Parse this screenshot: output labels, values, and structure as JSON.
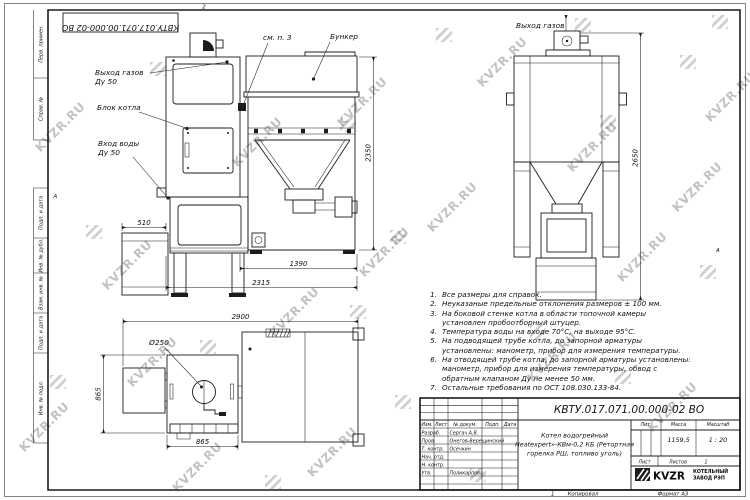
{
  "watermark": {
    "text": "KVZR.RU"
  },
  "colors": {
    "line": "#1c1c1c",
    "watermark": "#8a8a8a",
    "paper": "#ffffff"
  },
  "frame": {
    "stamp_top": "КВТУ.017.071.00.000-02 ВО",
    "zone_top": "2",
    "zone_left": "А",
    "zone_right": "А",
    "margin_labels": [
      "Перв. примен.",
      "Справ. №",
      "Подп. и дата",
      "Инв. № дубл.",
      "Взам. инв. №",
      "Подп. и дата",
      "Инв. № подл."
    ],
    "footer": {
      "num": "1",
      "copied": "Копировал",
      "format": "Формат А3"
    }
  },
  "callouts": {
    "gas_out_left_1": "Выход газов",
    "gas_out_left_2": "Ду 50",
    "boiler_block": "Блок котла",
    "water_in_1": "Вход воды",
    "water_in_2": "Ду 50",
    "see_note": "см. п. 3",
    "bunker": "Бункер",
    "gas_out_right": "Выход газов",
    "diameter": "Ø250"
  },
  "dims": {
    "d510": "510",
    "d1390": "1390",
    "d2315": "2315",
    "d2350": "2350",
    "d2650": "2650",
    "d2900": "2900",
    "d865v": "865",
    "d865h": "865"
  },
  "notes": [
    {
      "num": "1.",
      "text": "Все размеры для справок."
    },
    {
      "num": "2.",
      "text": "Неуказаные предельные отклонения размеров ± 100 мм."
    },
    {
      "num": "3.",
      "text": "На боковой стенке котла в области топочной камеры установлен пробоотборный штуцер."
    },
    {
      "num": "4.",
      "text": "Температура воды на входе 70°С, на выходе 95°С."
    },
    {
      "num": "5.",
      "text": "На подводящей трубе котла, до запорной арматуры установлены: манометр, прибор для измерения температуры."
    },
    {
      "num": "6.",
      "text": "На отводящей трубе котла, до запорной арматуры установлены: манометр, прибор для измерения температуры, обвод с обратным клапаном Ду не менее 50 мм."
    },
    {
      "num": "7.",
      "text": "Остальные требования по ОСТ 108.030.133-84."
    }
  ],
  "title_block": {
    "doc_number": "КВТУ.017.071.00.000-02 ВО",
    "headers": {
      "izm": "Изм.",
      "list": "Лист",
      "doc": "№ докум.",
      "podp": "Подп.",
      "data": "Дата"
    },
    "rows": [
      {
        "role": "Разраб.",
        "name": "Сергач А.В."
      },
      {
        "role": "Пров.",
        "name": "Онегов-Верещинский"
      },
      {
        "role": "Т. контр.",
        "name": "Осечкин"
      },
      {
        "role": "Нач. отд.",
        "name": ""
      },
      {
        "role": "Н. контр.",
        "name": ""
      },
      {
        "role": "Утв.",
        "name": "Поликарпова"
      }
    ],
    "title_l1": "Котел водогрейный",
    "title_l2": "Heatexpert»-КВм-0,2 КБ (Ретортная",
    "title_l3": "горелка РШ, топливо уголь)",
    "lit_label": "Лит.",
    "mass_label": "Масса",
    "scale_label": "Масштаб",
    "mass": "1159,5",
    "scale": "1 : 20",
    "sheet_label": "Лист",
    "sheets_label": "Листов",
    "sheets_value": "1",
    "logo_text": "KVZR",
    "company_line1": "КОТЕЛЬНЫЙ",
    "company_line2": "ЗАВОД РЭП"
  }
}
